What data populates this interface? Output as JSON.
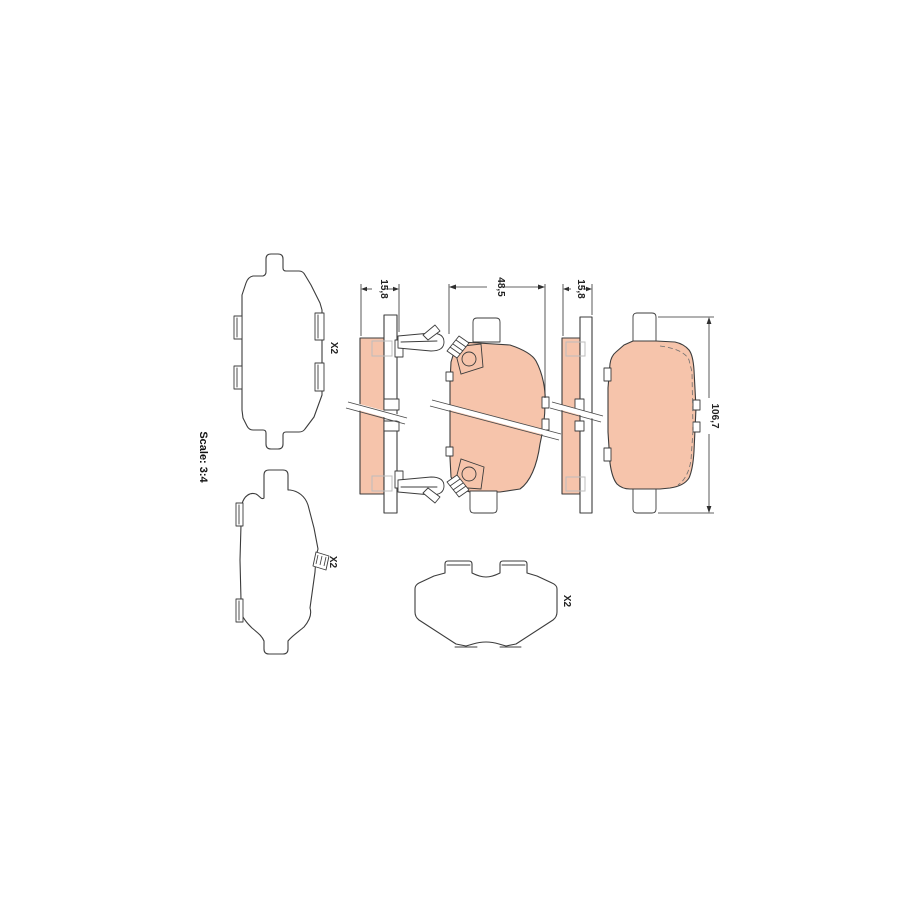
{
  "drawing": {
    "scale_label": "Scale: 3:4",
    "labels": {
      "shim_top_left_qty": "X2",
      "shim_bottom_left_qty": "X2",
      "shim_bottom_center_qty": "X2"
    },
    "dimensions": {
      "pad_thickness_side_view": "15,8",
      "pad_width_front_view": "48,5",
      "pad_thickness_right_view": "15,8",
      "pad_length_back_view": "106,7"
    },
    "colors": {
      "friction_material": "#f6c4ab",
      "outline": "#3c3c3c",
      "dimension_lines": "#2f2f2f",
      "light_detail": "#bdbdbd",
      "background": "#ffffff"
    }
  }
}
